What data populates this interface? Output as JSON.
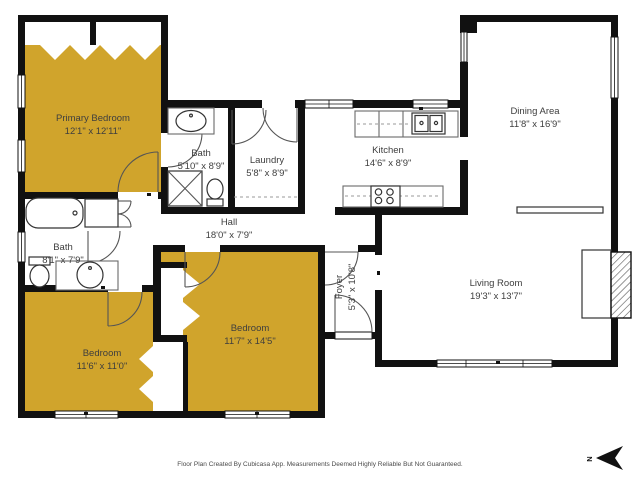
{
  "page": {
    "type": "floor-plan",
    "background": "#ffffff"
  },
  "colors": {
    "bedroom_highlight": "#D0A42C",
    "wall": "#111111",
    "label_text": "#3E3E3E",
    "fixture_line": "#6A6A6A"
  },
  "rooms": {
    "primary_bedroom": {
      "name": "Primary Bedroom",
      "dims": "12'1\" x 12'11\"",
      "highlighted": true
    },
    "primary_bath": {
      "name": "Bath",
      "dims": "5'10\" x 8'9\"",
      "highlighted": false
    },
    "laundry": {
      "name": "Laundry",
      "dims": "5'8\" x 8'9\"",
      "highlighted": false
    },
    "kitchen": {
      "name": "Kitchen",
      "dims": "14'6\" x 8'9\"",
      "highlighted": false
    },
    "dining_area": {
      "name": "Dining Area",
      "dims": "11'8\" x 16'9\"",
      "highlighted": false
    },
    "living_room": {
      "name": "Living Room",
      "dims": "19'3\" x 13'7\"",
      "highlighted": false
    },
    "hall": {
      "name": "Hall",
      "dims": "18'0\" x 7'9\"",
      "highlighted": false
    },
    "hall_bath": {
      "name": "Bath",
      "dims": "8'1\" x 7'9\"",
      "highlighted": false
    },
    "bedroom_sw": {
      "name": "Bedroom",
      "dims": "11'6\" x 11'0\"",
      "highlighted": true
    },
    "bedroom_s": {
      "name": "Bedroom",
      "dims": "11'7\" x 14'5\"",
      "highlighted": true
    },
    "foyer": {
      "name": "Foyer",
      "dims": "5'3\" x 10'8\"",
      "highlighted": false
    }
  },
  "compass": {
    "label": "N"
  },
  "footer": {
    "disclaimer": "Floor Plan Created By Cubicasa App. Measurements Deemed Highly Reliable But Not Guaranteed."
  }
}
